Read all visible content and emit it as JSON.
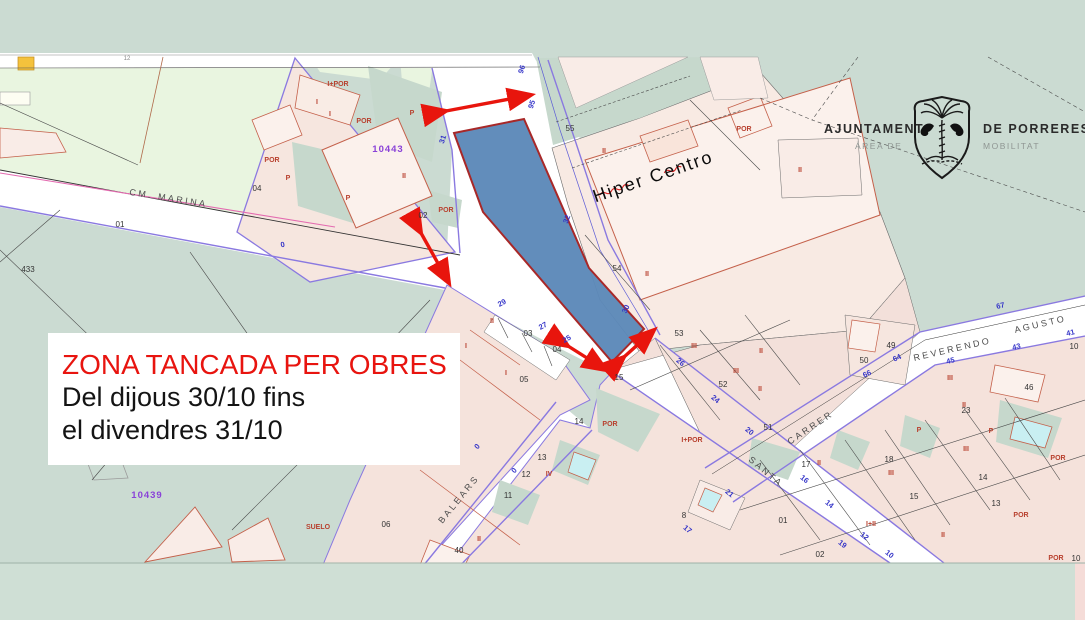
{
  "notice": {
    "title": "ZONA TANCADA PER OBRES",
    "line1": "Del dijous 30/10 fins",
    "line2": "el divendres 31/10"
  },
  "logo": {
    "left_main": "AJUNTAMENT",
    "left_sub": "ÀREA DE",
    "right_main": "DE PORRERES",
    "right_sub": "MOBILITAT",
    "emblem": "shield-palm-tree-two-birds"
  },
  "colors": {
    "map_background": "#cbdbd2",
    "field_green": "#e9f5e0",
    "urban_pink": "#f6e6df",
    "building_fill": "#fbf1ec",
    "road_white": "#ffffff",
    "closed_zone_fill": "#5c88b8",
    "closed_zone_border": "#a82828",
    "arrow_red": "#e8150d",
    "notice_red": "#e8140f",
    "road_edge_purple": "#8a79e0",
    "house_number_blue": "#3434c8",
    "construction_red": "#b8402e",
    "reference_purple": "#8a42d8",
    "pool_cyan": "#c9eff2"
  },
  "map": {
    "labels": [
      {
        "k": "street",
        "t": "CM. MARINA",
        "x": 168,
        "y": 201,
        "r": 9
      },
      {
        "k": "street",
        "t": "BALEARS",
        "x": 461,
        "y": 501,
        "r": -51
      },
      {
        "k": "street",
        "t": "SANTA",
        "x": 764,
        "y": 474,
        "r": 40
      },
      {
        "k": "street",
        "t": "CARRER",
        "x": 812,
        "y": 430,
        "r": -34
      },
      {
        "k": "street",
        "t": "REVERENDO",
        "x": 953,
        "y": 352,
        "r": -13
      },
      {
        "k": "street",
        "t": "AGUSTO",
        "x": 1041,
        "y": 327,
        "r": -13
      },
      {
        "k": "poi",
        "t": "Hiper Centro",
        "x": 655,
        "y": 182,
        "r": -19
      },
      {
        "k": "ref",
        "t": "10443",
        "x": 388,
        "y": 152
      },
      {
        "k": "ref",
        "t": "10439",
        "x": 147,
        "y": 498
      },
      {
        "k": "tiny",
        "t": "12",
        "x": 127,
        "y": 60
      },
      {
        "k": "pnum",
        "t": "433",
        "x": 28,
        "y": 272
      },
      {
        "k": "pnum",
        "t": "01",
        "x": 120,
        "y": 227
      },
      {
        "k": "pnum",
        "t": "02",
        "x": 423,
        "y": 218
      },
      {
        "k": "pnum",
        "t": "04",
        "x": 257,
        "y": 191
      },
      {
        "k": "pnum",
        "t": "55",
        "x": 570,
        "y": 131
      },
      {
        "k": "pnum",
        "t": "54",
        "x": 617,
        "y": 271
      },
      {
        "k": "pnum",
        "t": "53",
        "x": 679,
        "y": 336
      },
      {
        "k": "pnum",
        "t": "52",
        "x": 723,
        "y": 387
      },
      {
        "k": "pnum",
        "t": "51",
        "x": 768,
        "y": 430
      },
      {
        "k": "pnum",
        "t": "50",
        "x": 864,
        "y": 363
      },
      {
        "k": "pnum",
        "t": "49",
        "x": 891,
        "y": 348
      },
      {
        "k": "pnum",
        "t": "03",
        "x": 528,
        "y": 336
      },
      {
        "k": "pnum",
        "t": "04",
        "x": 557,
        "y": 352
      },
      {
        "k": "pnum",
        "t": "05",
        "x": 524,
        "y": 382
      },
      {
        "k": "pnum",
        "t": "15",
        "x": 619,
        "y": 380
      },
      {
        "k": "pnum",
        "t": "14",
        "x": 579,
        "y": 424
      },
      {
        "k": "pnum",
        "t": "13",
        "x": 542,
        "y": 460
      },
      {
        "k": "pnum",
        "t": "12",
        "x": 526,
        "y": 477
      },
      {
        "k": "pnum",
        "t": "11",
        "x": 508,
        "y": 498
      },
      {
        "k": "pnum",
        "t": "40",
        "x": 459,
        "y": 553
      },
      {
        "k": "pnum",
        "t": "06",
        "x": 386,
        "y": 527
      },
      {
        "k": "pnum",
        "t": "8",
        "x": 684,
        "y": 518
      },
      {
        "k": "pnum",
        "t": "01",
        "x": 783,
        "y": 523
      },
      {
        "k": "pnum",
        "t": "02",
        "x": 820,
        "y": 557
      },
      {
        "k": "pnum",
        "t": "17",
        "x": 806,
        "y": 467
      },
      {
        "k": "pnum",
        "t": "18",
        "x": 889,
        "y": 462
      },
      {
        "k": "pnum",
        "t": "15",
        "x": 914,
        "y": 499
      },
      {
        "k": "pnum",
        "t": "14",
        "x": 983,
        "y": 480
      },
      {
        "k": "pnum",
        "t": "13",
        "x": 996,
        "y": 506
      },
      {
        "k": "pnum",
        "t": "23",
        "x": 966,
        "y": 413
      },
      {
        "k": "pnum",
        "t": "46",
        "x": 1029,
        "y": 390
      },
      {
        "k": "pnum",
        "t": "10",
        "x": 1074,
        "y": 349
      },
      {
        "k": "pnum",
        "t": "10",
        "x": 1076,
        "y": 561
      },
      {
        "k": "hnum",
        "t": "96",
        "x": 524,
        "y": 70,
        "r": -72
      },
      {
        "k": "hnum",
        "t": "95",
        "x": 534,
        "y": 105,
        "r": -72
      },
      {
        "k": "hnum",
        "t": "31",
        "x": 445,
        "y": 140,
        "r": -72
      },
      {
        "k": "hnum",
        "t": "32",
        "x": 569,
        "y": 220,
        "r": -70
      },
      {
        "k": "hnum",
        "t": "30",
        "x": 628,
        "y": 310,
        "r": -65
      },
      {
        "k": "hnum",
        "t": "29",
        "x": 503,
        "y": 305,
        "r": -28
      },
      {
        "k": "hnum",
        "t": "27",
        "x": 544,
        "y": 328,
        "r": -28
      },
      {
        "k": "hnum",
        "t": "25",
        "x": 568,
        "y": 341,
        "r": -30
      },
      {
        "k": "hnum",
        "t": "0",
        "x": 283,
        "y": 247,
        "r": -10
      },
      {
        "k": "hnum",
        "t": "0",
        "x": 479,
        "y": 448,
        "r": -50
      },
      {
        "k": "hnum",
        "t": "0",
        "x": 516,
        "y": 472,
        "r": -50
      },
      {
        "k": "hnum",
        "t": "26",
        "x": 679,
        "y": 364,
        "r": 38
      },
      {
        "k": "hnum",
        "t": "24",
        "x": 714,
        "y": 401,
        "r": 38
      },
      {
        "k": "hnum",
        "t": "20",
        "x": 748,
        "y": 433,
        "r": 38
      },
      {
        "k": "hnum",
        "t": "21",
        "x": 728,
        "y": 495,
        "r": 40
      },
      {
        "k": "hnum",
        "t": "17",
        "x": 686,
        "y": 531,
        "r": 40
      },
      {
        "k": "hnum",
        "t": "16",
        "x": 803,
        "y": 481,
        "r": 38
      },
      {
        "k": "hnum",
        "t": "14",
        "x": 828,
        "y": 506,
        "r": 38
      },
      {
        "k": "hnum",
        "t": "12",
        "x": 863,
        "y": 538,
        "r": 38
      },
      {
        "k": "hnum",
        "t": "19",
        "x": 841,
        "y": 546,
        "r": 38
      },
      {
        "k": "hnum",
        "t": "10",
        "x": 888,
        "y": 556,
        "r": 38
      },
      {
        "k": "hnum",
        "t": "64",
        "x": 898,
        "y": 360,
        "r": -25
      },
      {
        "k": "hnum",
        "t": "66",
        "x": 868,
        "y": 376,
        "r": -25
      },
      {
        "k": "hnum",
        "t": "67",
        "x": 1001,
        "y": 308,
        "r": -13
      },
      {
        "k": "hnum",
        "t": "45",
        "x": 951,
        "y": 363,
        "r": -13
      },
      {
        "k": "hnum",
        "t": "43",
        "x": 1017,
        "y": 349,
        "r": -13
      },
      {
        "k": "hnum",
        "t": "41",
        "x": 1071,
        "y": 335,
        "r": -13
      },
      {
        "k": "con",
        "t": "I+POR",
        "x": 338,
        "y": 86
      },
      {
        "k": "con",
        "t": "POR",
        "x": 364,
        "y": 123
      },
      {
        "k": "con",
        "t": "POR",
        "x": 272,
        "y": 162
      },
      {
        "k": "con",
        "t": "POR",
        "x": 446,
        "y": 212
      },
      {
        "k": "con",
        "t": "II",
        "x": 404,
        "y": 178
      },
      {
        "k": "con",
        "t": "P",
        "x": 412,
        "y": 115
      },
      {
        "k": "con",
        "t": "P",
        "x": 288,
        "y": 180
      },
      {
        "k": "con",
        "t": "P",
        "x": 348,
        "y": 200
      },
      {
        "k": "con",
        "t": "I",
        "x": 317,
        "y": 104
      },
      {
        "k": "con",
        "t": "I",
        "x": 330,
        "y": 116
      },
      {
        "k": "con",
        "t": "II",
        "x": 604,
        "y": 153
      },
      {
        "k": "con",
        "t": "POR",
        "x": 744,
        "y": 131
      },
      {
        "k": "con",
        "t": "II",
        "x": 647,
        "y": 276
      },
      {
        "k": "con",
        "t": "II",
        "x": 800,
        "y": 172
      },
      {
        "k": "con",
        "t": "II",
        "x": 492,
        "y": 323
      },
      {
        "k": "con",
        "t": "I",
        "x": 466,
        "y": 348
      },
      {
        "k": "con",
        "t": "I",
        "x": 506,
        "y": 375
      },
      {
        "k": "con",
        "t": "III",
        "x": 694,
        "y": 348
      },
      {
        "k": "con",
        "t": "III",
        "x": 736,
        "y": 373
      },
      {
        "k": "con",
        "t": "II",
        "x": 761,
        "y": 353
      },
      {
        "k": "con",
        "t": "II",
        "x": 760,
        "y": 391
      },
      {
        "k": "con",
        "t": "POR",
        "x": 610,
        "y": 426
      },
      {
        "k": "con",
        "t": "I+POR",
        "x": 692,
        "y": 442
      },
      {
        "k": "con",
        "t": "IV",
        "x": 549,
        "y": 476
      },
      {
        "k": "con",
        "t": "II",
        "x": 479,
        "y": 541
      },
      {
        "k": "con",
        "t": "III",
        "x": 950,
        "y": 380
      },
      {
        "k": "con",
        "t": "II",
        "x": 964,
        "y": 407
      },
      {
        "k": "con",
        "t": "P",
        "x": 919,
        "y": 432
      },
      {
        "k": "con",
        "t": "P",
        "x": 991,
        "y": 433
      },
      {
        "k": "con",
        "t": "III",
        "x": 966,
        "y": 451
      },
      {
        "k": "con",
        "t": "II",
        "x": 819,
        "y": 465
      },
      {
        "k": "con",
        "t": "III",
        "x": 891,
        "y": 475
      },
      {
        "k": "con",
        "t": "I+II",
        "x": 871,
        "y": 526
      },
      {
        "k": "con",
        "t": "II",
        "x": 943,
        "y": 537
      },
      {
        "k": "con",
        "t": "POR",
        "x": 1058,
        "y": 460
      },
      {
        "k": "con",
        "t": "POR",
        "x": 1021,
        "y": 517
      },
      {
        "k": "con",
        "t": "POR",
        "x": 1056,
        "y": 560
      },
      {
        "k": "con",
        "t": "SUELO",
        "x": 318,
        "y": 529
      }
    ]
  }
}
